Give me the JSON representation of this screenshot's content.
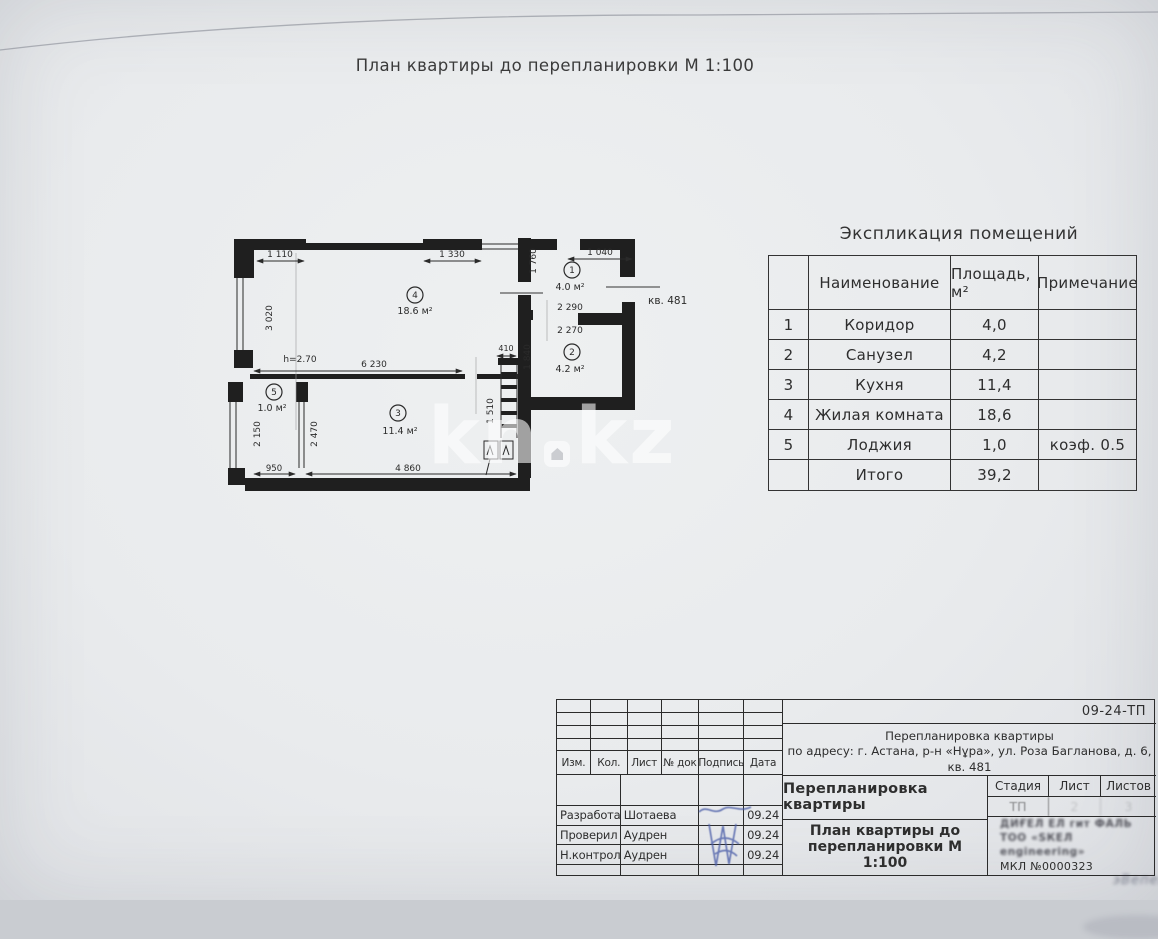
{
  "page": {
    "title": "План квартиры до перепланировки М 1:100"
  },
  "watermark": {
    "left": "kn",
    "right": "kz"
  },
  "plan": {
    "apartment_label": "кв. 481",
    "height_label": "h=2.70",
    "rooms": {
      "r1": {
        "num": "1",
        "area": "4.0 м²"
      },
      "r2": {
        "num": "2",
        "area": "4.2 м²"
      },
      "r3": {
        "num": "3",
        "area": "11.4 м²"
      },
      "r4": {
        "num": "4",
        "area": "18.6 м²"
      },
      "r5": {
        "num": "5",
        "area": "1.0 м²"
      }
    },
    "dims": {
      "d1110": "1 110",
      "d3020": "3 020",
      "d1330": "1 330",
      "d1760": "1 760",
      "d1040": "1 040",
      "d2290": "2 290",
      "d2270": "2 270",
      "d1840": "1 840",
      "d410": "410",
      "d6230": "6 230",
      "d1510": "1 510",
      "d2150": "2 150",
      "d2470": "2 470",
      "d950": "950",
      "d4860": "4 860"
    }
  },
  "explication": {
    "title": "Экспликация помещений",
    "headers": [
      "",
      "Наименование",
      "Площадь, м²",
      "Примечание"
    ],
    "rows": [
      [
        "1",
        "Коридор",
        "4,0",
        ""
      ],
      [
        "2",
        "Санузел",
        "4,2",
        ""
      ],
      [
        "3",
        "Кухня",
        "11,4",
        ""
      ],
      [
        "4",
        "Жилая комната",
        "18,6",
        ""
      ],
      [
        "5",
        "Лоджия",
        "1,0",
        "коэф. 0.5"
      ],
      [
        "",
        "Итого",
        "39,2",
        ""
      ]
    ]
  },
  "titleblock": {
    "doc_number": "09-24-ТП",
    "project_line1": "Перепланировка квартиры",
    "project_line2": "по адресу: г. Астана, р-н «Нұра», ул. Роза Багланова, д. 6,",
    "project_line3": "кв. 481",
    "columns": {
      "izm": "Изм.",
      "kol": "Кол.",
      "list": "Лист",
      "doc": "№ док",
      "sign": "Подпись",
      "date": "Дата"
    },
    "staff": [
      {
        "role": "Разработал",
        "name": "Шотаева",
        "date": "09.24"
      },
      {
        "role": "Проверил",
        "name": "Аудрен",
        "date": "09.24"
      },
      {
        "role": "Н.контроль",
        "name": "Аудрен",
        "date": "09.24"
      }
    ],
    "doc_title_upper": "Перепланировка квартиры",
    "doc_title_lower": "План квартиры до перепланировки М 1:100",
    "stage": {
      "label_stage": "Стадия",
      "label_sheet": "Лист",
      "label_sheets": "Листов",
      "stage_value": "ТП",
      "sheet_value": "2",
      "sheets_value": "3"
    },
    "org": {
      "illegible1": "ДИҒЕЛ ЕЛ гит ФАЛЬ",
      "illegible2": "ТОО «SКЕЛ engineering»",
      "license": "МКЛ №0000323"
    },
    "stamp_smudge": "эВепехиш"
  }
}
